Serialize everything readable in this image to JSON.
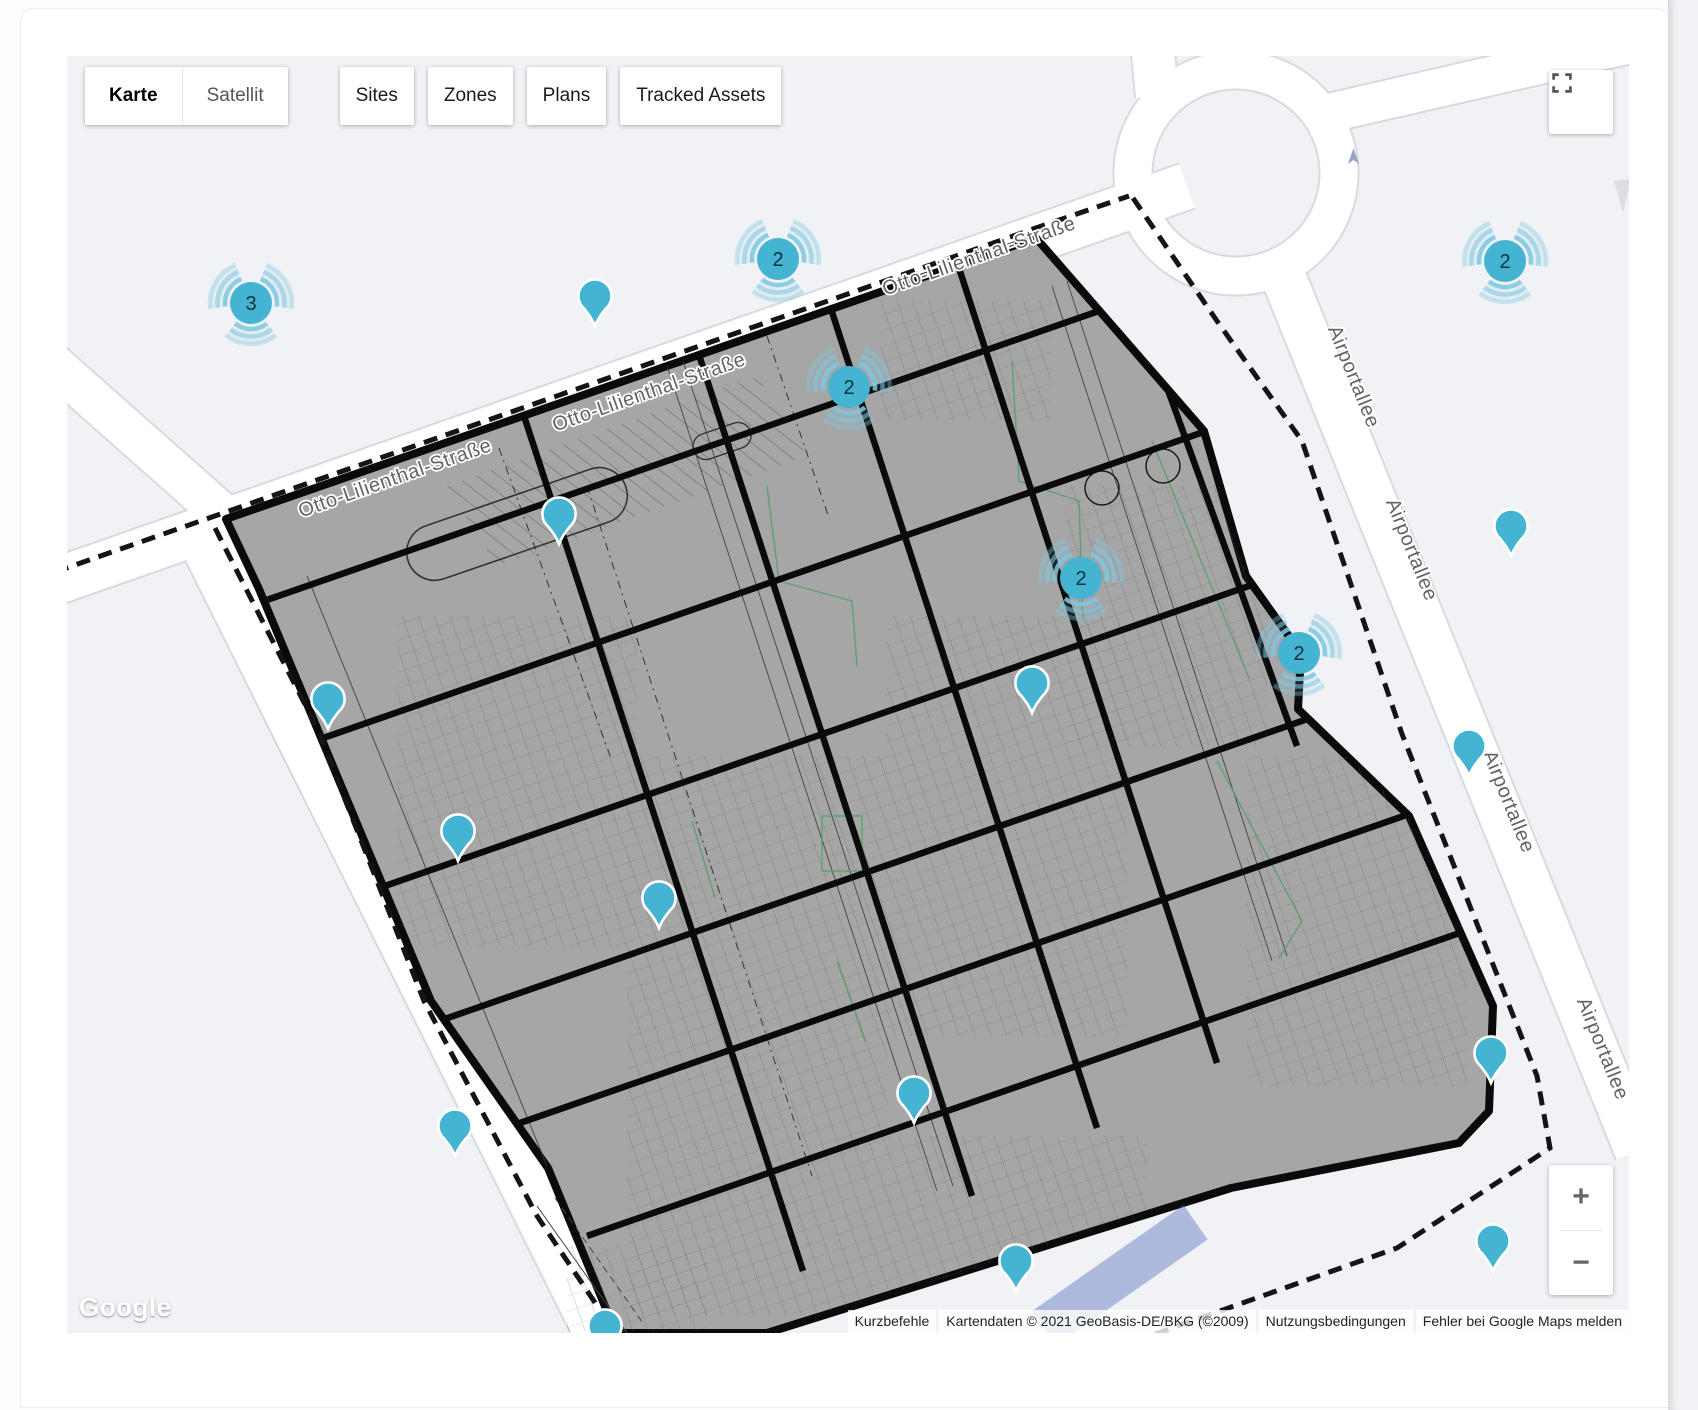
{
  "toolbar": {
    "map_types": [
      {
        "label": "Karte",
        "active": true
      },
      {
        "label": "Satellit",
        "active": false
      }
    ],
    "tabs": [
      "Sites",
      "Zones",
      "Plans",
      "Tracked Assets"
    ]
  },
  "map": {
    "street_names": {
      "otto": "Otto-Lilienthal-Straße",
      "airportallee": "Airportallee"
    },
    "street_labels": [
      {
        "street": "otto",
        "x": 330,
        "y": 428,
        "rot": -19.3
      },
      {
        "street": "otto",
        "x": 584,
        "y": 342,
        "rot": -19.3
      },
      {
        "street": "otto",
        "x": 914,
        "y": 206,
        "rot": -19.3
      },
      {
        "street": "airportallee",
        "x": 1281,
        "y": 323,
        "rot": 68
      },
      {
        "street": "airportallee",
        "x": 1339,
        "y": 496,
        "rot": 68
      },
      {
        "street": "airportallee",
        "x": 1436,
        "y": 748,
        "rot": 68
      },
      {
        "street": "airportallee",
        "x": 1530,
        "y": 995,
        "rot": 68
      }
    ],
    "clusters": [
      {
        "x": 184,
        "y": 247,
        "count": "3"
      },
      {
        "x": 711,
        "y": 203,
        "count": "2"
      },
      {
        "x": 782,
        "y": 331,
        "count": "2"
      },
      {
        "x": 1014,
        "y": 522,
        "count": "2"
      },
      {
        "x": 1232,
        "y": 597,
        "count": "2"
      },
      {
        "x": 1438,
        "y": 205,
        "count": "2"
      }
    ],
    "pins": [
      {
        "x": 528,
        "y": 270
      },
      {
        "x": 492,
        "y": 488
      },
      {
        "x": 261,
        "y": 673
      },
      {
        "x": 391,
        "y": 805
      },
      {
        "x": 592,
        "y": 872
      },
      {
        "x": 965,
        "y": 657
      },
      {
        "x": 847,
        "y": 1067
      },
      {
        "x": 949,
        "y": 1235
      },
      {
        "x": 388,
        "y": 1100
      },
      {
        "x": 538,
        "y": 1300
      },
      {
        "x": 1402,
        "y": 720
      },
      {
        "x": 1424,
        "y": 1027
      },
      {
        "x": 1444,
        "y": 500
      },
      {
        "x": 1426,
        "y": 1215
      }
    ],
    "colors": {
      "marker": "#45b4d3",
      "ripple": "#7ec8e0",
      "map_bg": "#f0f2f5",
      "site_fill": "#a6a6a6"
    },
    "zoom_in_label": "+",
    "zoom_out_label": "−"
  },
  "attribution": {
    "shortcuts_label": "Kurzbefehle",
    "map_data": "Kartendaten © 2021 GeoBasis-DE/BKG (©2009)",
    "terms_label": "Nutzungsbedingungen",
    "report_label": "Fehler bei Google Maps melden"
  },
  "logo": {
    "text": "Google"
  }
}
